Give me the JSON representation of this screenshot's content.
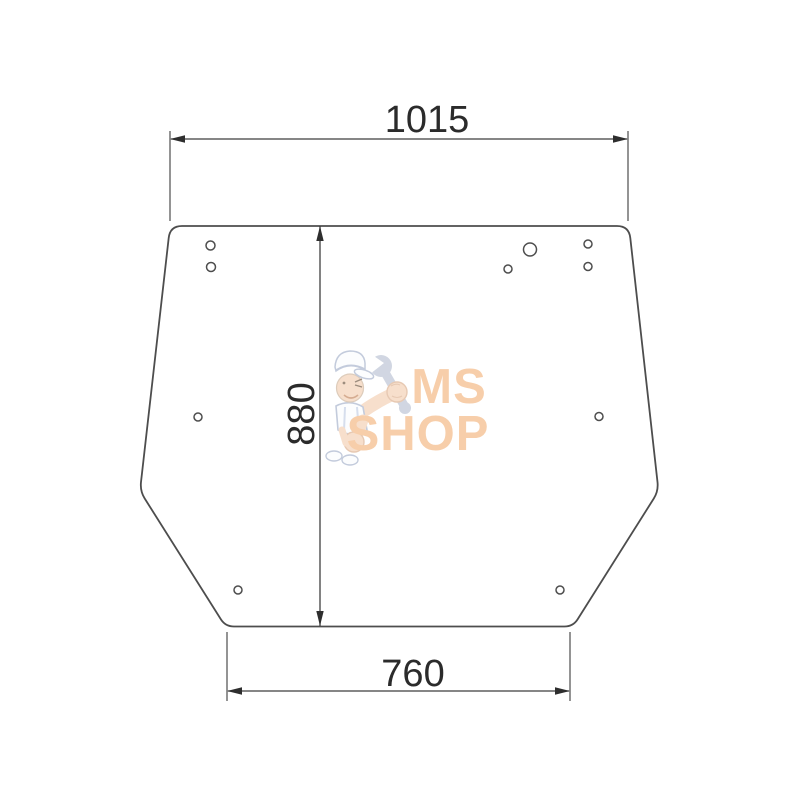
{
  "diagram": {
    "dimension_labels": {
      "top_width": "1015",
      "height": "880",
      "bottom_width": "760"
    }
  },
  "glass": {
    "holes": [
      {
        "cx": 210.5,
        "cy": 245.5,
        "r": 4.5
      },
      {
        "cx": 211,
        "cy": 267,
        "r": 4.5
      },
      {
        "cx": 530,
        "cy": 249.5,
        "r": 6.5
      },
      {
        "cx": 508,
        "cy": 269,
        "r": 4
      },
      {
        "cx": 588,
        "cy": 244,
        "r": 4
      },
      {
        "cx": 588,
        "cy": 266.5,
        "r": 4
      },
      {
        "cx": 198,
        "cy": 417,
        "r": 4
      },
      {
        "cx": 599,
        "cy": 416.5,
        "r": 4
      },
      {
        "cx": 238,
        "cy": 590,
        "r": 4
      },
      {
        "cx": 560,
        "cy": 590,
        "r": 4
      }
    ]
  },
  "watermark": {
    "line1": "MS",
    "line2": "SHOP",
    "text_color": "#f6c69c"
  },
  "colors": {
    "line": "#4d4d4d",
    "dimension_text": "#2b2b2b",
    "background": "#ffffff"
  }
}
